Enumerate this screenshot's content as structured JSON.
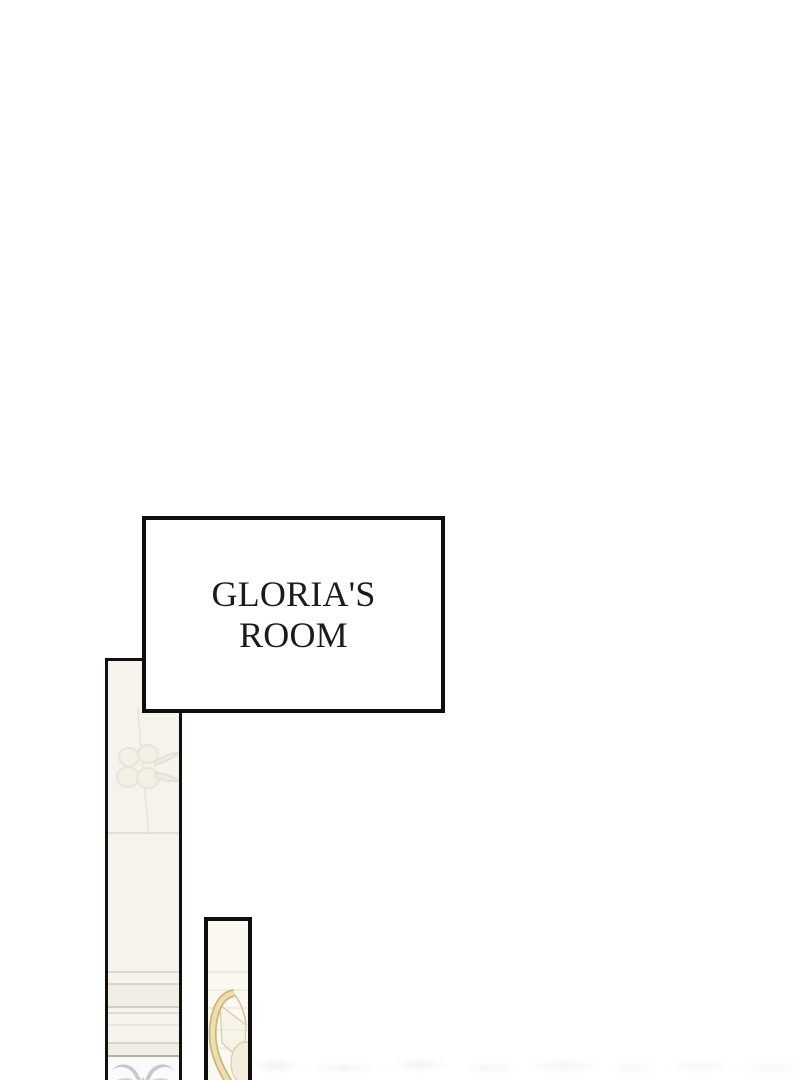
{
  "label_box": {
    "line1": "GLORIA'S",
    "line2": "ROOM"
  },
  "colors": {
    "ink": "#101010",
    "wall_fill": "#f6f3ec",
    "post_fill": "#faf8f1",
    "gold_band": "#eedfae",
    "gold_outline": "#cbb67f",
    "damask_gray": "#bcc0ca"
  },
  "ornaments": {
    "flower": "faint-flower-ornament",
    "damask": "gray-damask-scroll-ornament",
    "gold_curve": "gold-harp-curve-ornament"
  }
}
